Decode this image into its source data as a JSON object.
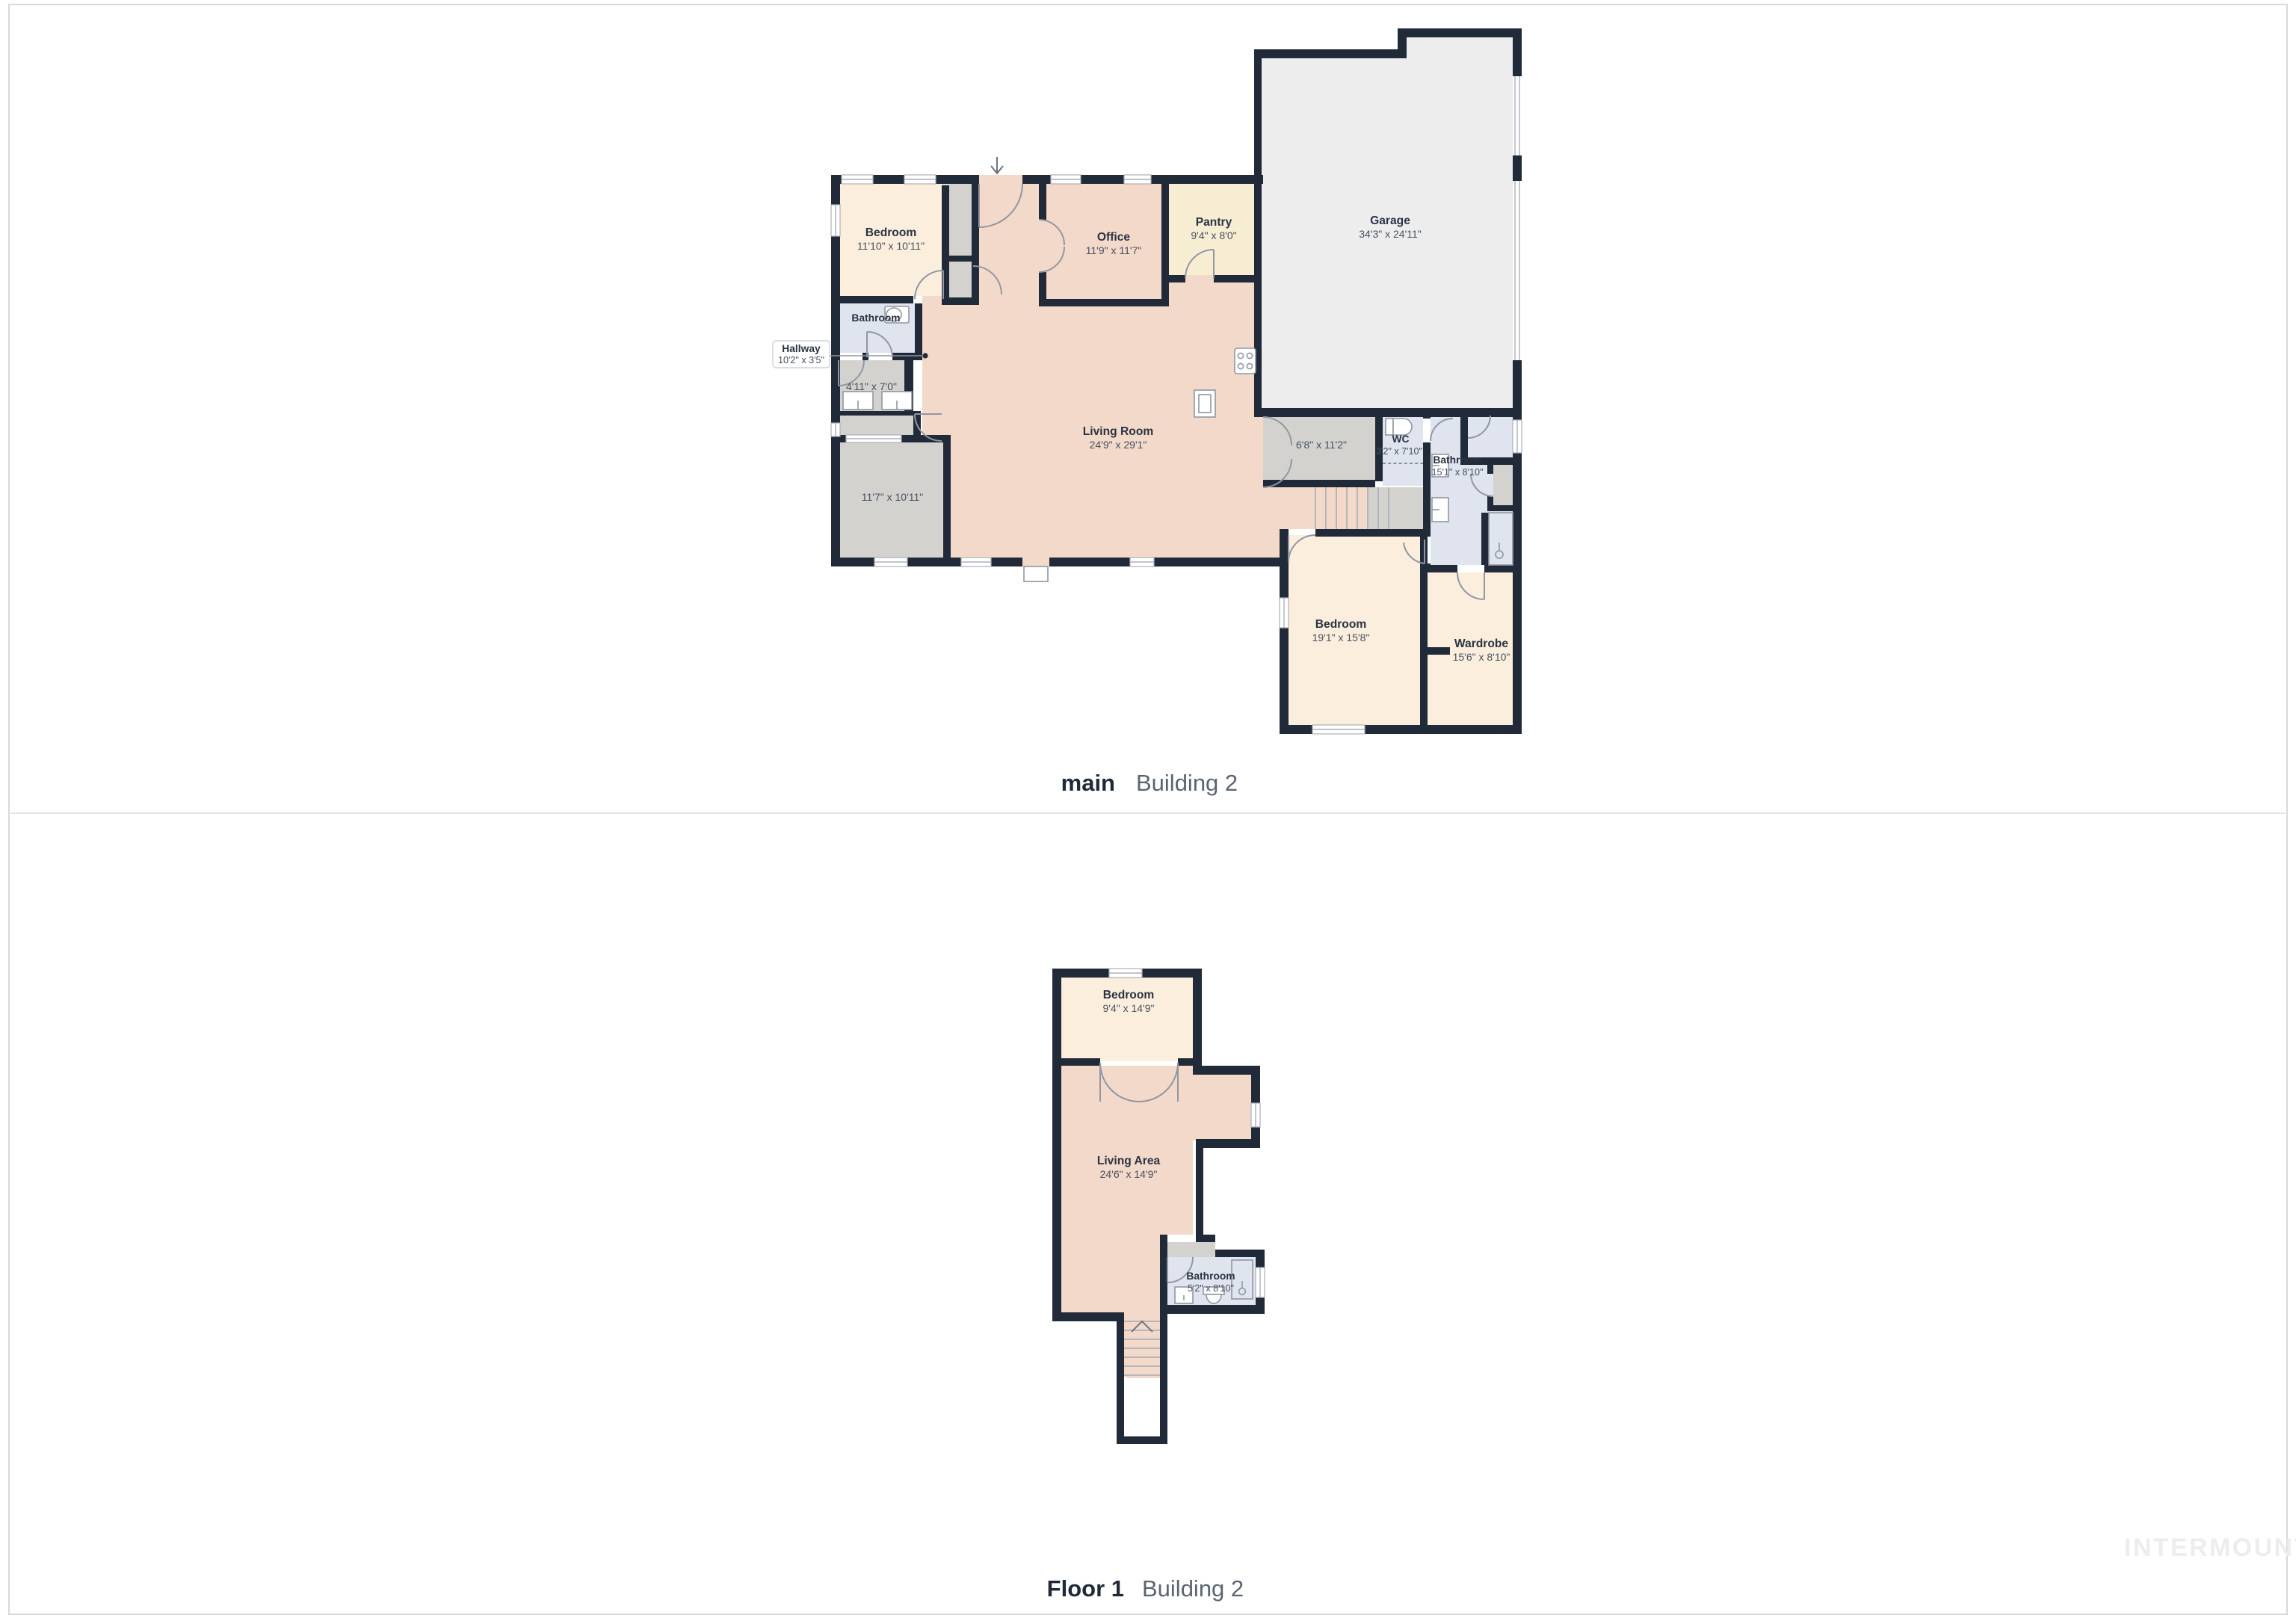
{
  "floors": [
    {
      "label": "main",
      "building": "Building 2",
      "rooms": {
        "bedroom_left": {
          "name": "Bedroom",
          "dims": "11'10\" x 10'11\""
        },
        "office": {
          "name": "Office",
          "dims": "11'9\" x 11'7\""
        },
        "pantry": {
          "name": "Pantry",
          "dims": "9'4\" x 8'0\""
        },
        "garage": {
          "name": "Garage",
          "dims": "34'3\" x 24'11\""
        },
        "bathroom_left": {
          "name": "Bathroom"
        },
        "hallway": {
          "name": "Hallway",
          "dims": "10'2\" x 3'5\""
        },
        "utility": {
          "dims": "4'11\" x 7'0\""
        },
        "room_lower_left": {
          "dims": "11'7\" x 10'11\""
        },
        "living_room": {
          "name": "Living Room",
          "dims": "24'9\" x 29'1\""
        },
        "hall_right": {
          "dims": "6'8\" x 11'2\""
        },
        "wc": {
          "name": "WC",
          "dims": "3'2\" x 7'10\""
        },
        "bathroom_right": {
          "name": "Bathroom",
          "dims": "15'1\" x 8'10\""
        },
        "bedroom_right": {
          "name": "Bedroom",
          "dims": "19'1\" x 15'8\""
        },
        "wardrobe": {
          "name": "Wardrobe",
          "dims": "15'6\" x 8'10\""
        }
      }
    },
    {
      "label": "Floor 1",
      "building": "Building 2",
      "rooms": {
        "bedroom": {
          "name": "Bedroom",
          "dims": "9'4\" x 14'9\""
        },
        "living_area": {
          "name": "Living Area",
          "dims": "24'6\" x 14'9\""
        },
        "bathroom": {
          "name": "Bathroom",
          "dims": "5'2\" x 8'10\""
        }
      }
    }
  ],
  "watermark": "INTERMOUNTAIN",
  "colors": {
    "wall": "#212A39",
    "bedroom_fill": "#FBEEDC",
    "living_fill": "#F3D9CA",
    "pantry_fill": "#F7EDD3",
    "garage_fill": "#EDEDEE",
    "utility_fill": "#D4D2CE",
    "bath_fill": "#DFE4EF"
  }
}
